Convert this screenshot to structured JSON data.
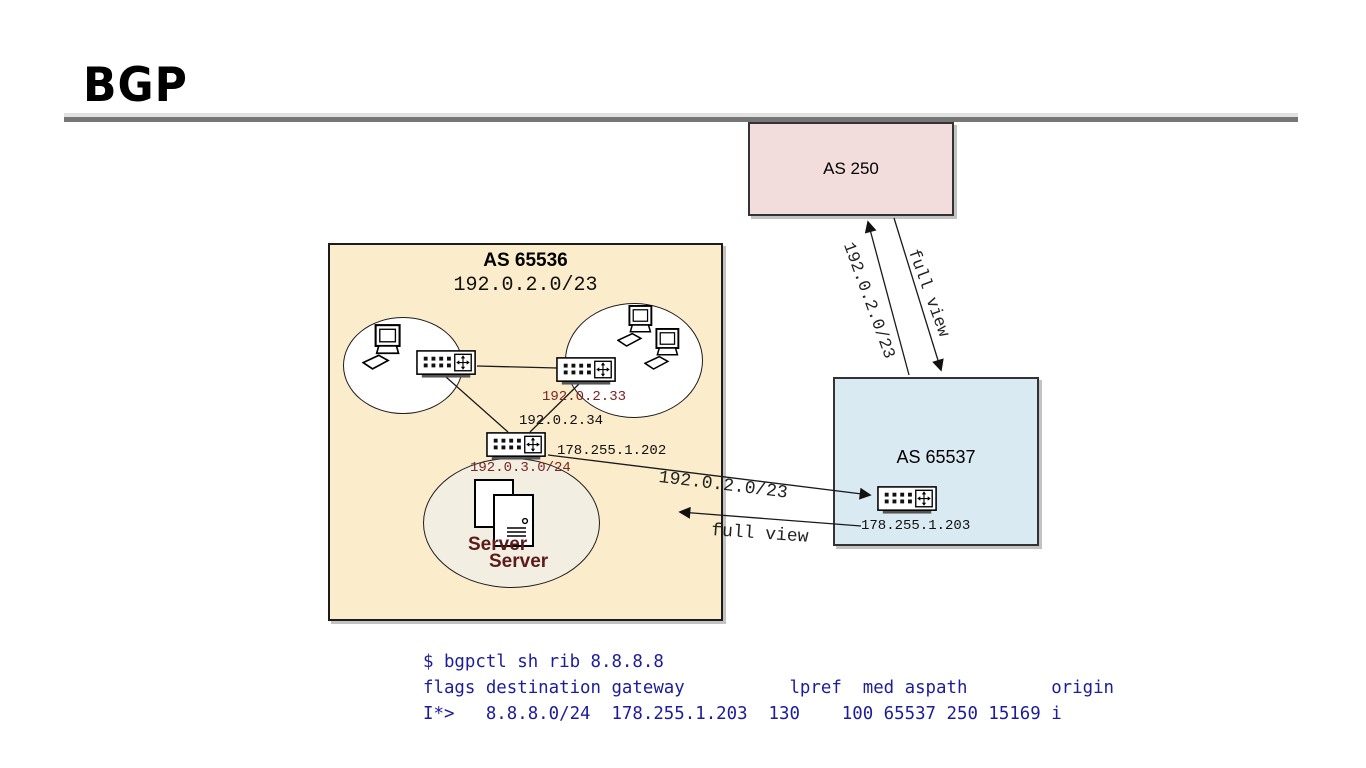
{
  "title": "BGP",
  "colors": {
    "as250-fill": "#f2dddc",
    "as65536-fill": "#fbeccb",
    "as65537-fill": "#daeaf2",
    "server-zone-fill": "#f2efe2",
    "rule-light": "#e2e2e2",
    "rule-dark": "#767676",
    "terminal-text": "#1c1c9c",
    "red-label": "#7a2525",
    "server-label": "#5c1a1a"
  },
  "as250": {
    "label": "AS 250"
  },
  "as65536": {
    "label": "AS 65536",
    "prefix": "192.0.2.0/23",
    "router_lan_ip": "192.0.2.33",
    "router_core_ip": "192.0.2.34",
    "router_core_wan_ip": "178.255.1.202",
    "server_subnet": "192.0.3.0/24",
    "server_back_label": "Server",
    "server_front_label": "Server"
  },
  "as65537": {
    "label": "AS 65537",
    "router_ip": "178.255.1.203"
  },
  "arrows": {
    "announce_to_as250": "192.0.2.0/23",
    "fullview_from_as250": "full view",
    "announce_to_as65537": "192.0.2.0/23",
    "fullview_from_as65537": "full view"
  },
  "terminal": {
    "command": "$ bgpctl sh rib 8.8.8.8",
    "header": "flags destination gateway          lpref  med aspath        origin",
    "row": "I*>   8.8.8.0/24  178.255.1.203  130    100 65537 250 15169 i"
  }
}
